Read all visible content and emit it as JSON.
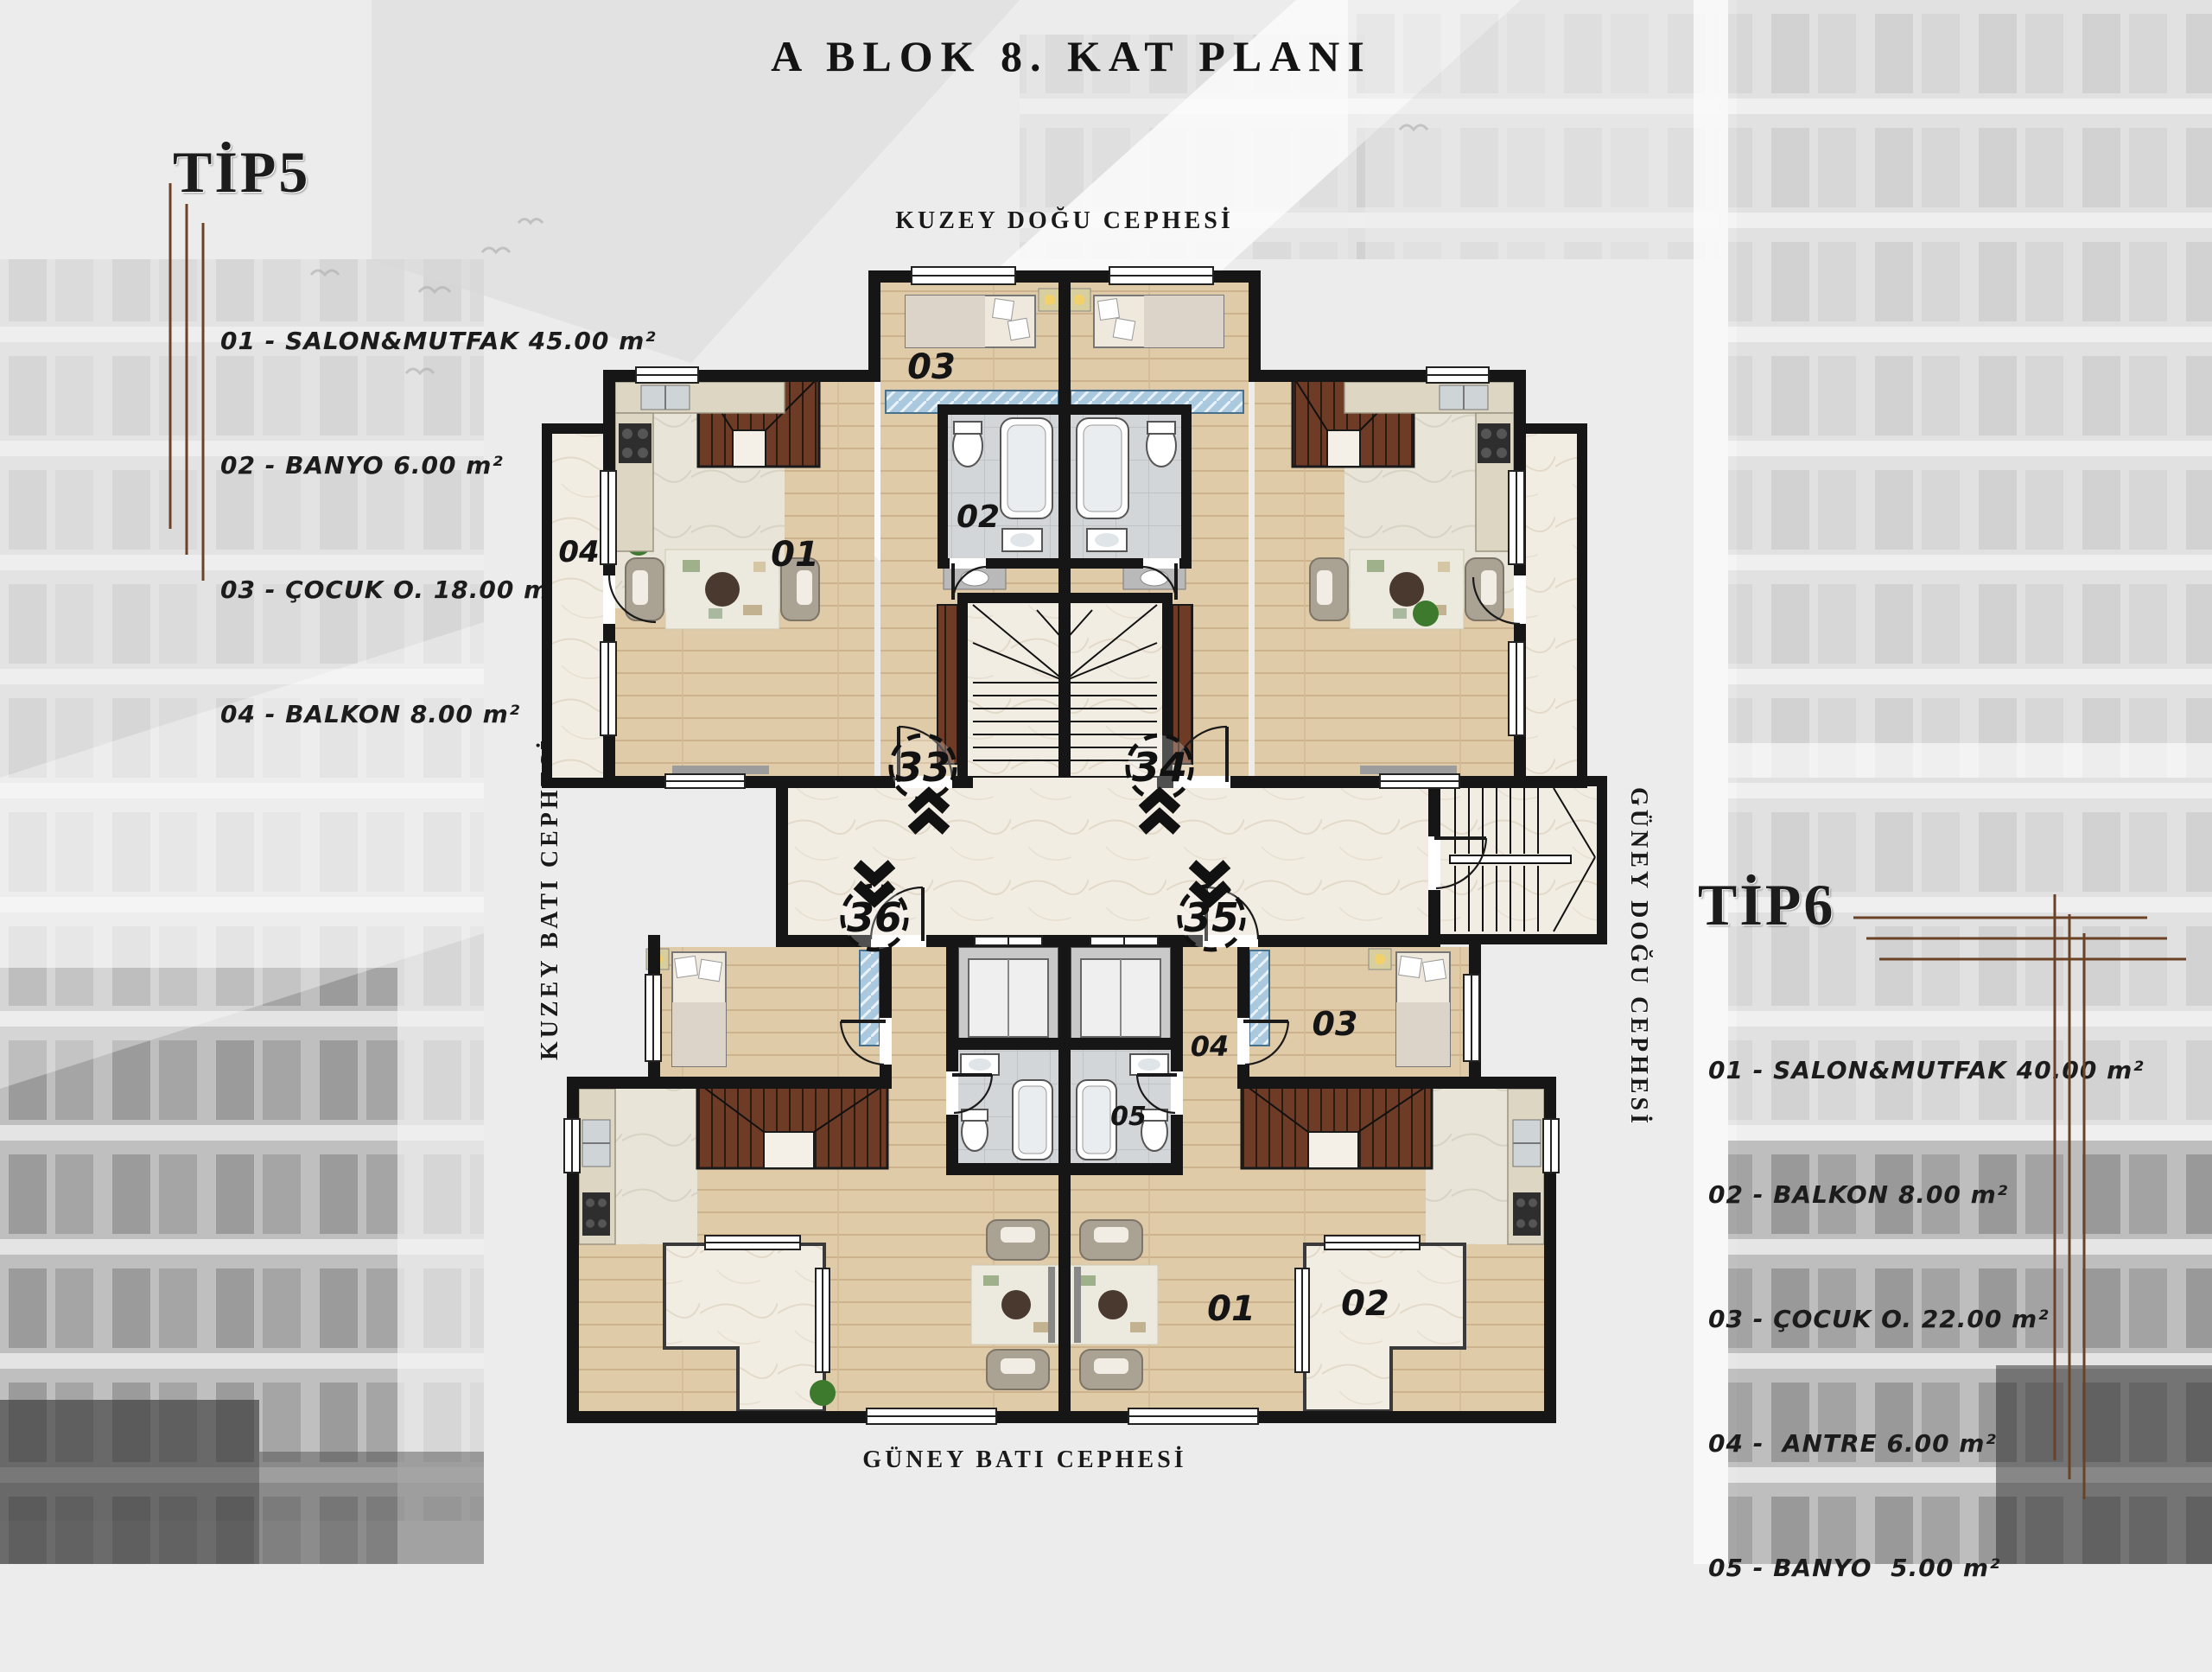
{
  "title": "A BLOK 8. KAT PLANI",
  "legends": {
    "tip5": {
      "heading": "TİP5",
      "items": [
        "01 - SALON&MUTFAK 45.00 m²",
        "02 - BANYO 6.00 m²",
        "03 - ÇOCUK O. 18.00 m²",
        "04 - BALKON 8.00 m²"
      ]
    },
    "tip6": {
      "heading": "TİP6",
      "items": [
        "01 - SALON&MUTFAK 40.00 m²",
        "02 - BALKON 8.00 m²",
        "03 - ÇOCUK O. 22.00 m²",
        "04 -  ANTRE 6.00 m²",
        "05 - BANYO  5.00 m²"
      ]
    }
  },
  "facades": {
    "top": "KUZEY DOĞU CEPHESİ",
    "bottom": "GÜNEY BATI CEPHESİ",
    "left": "KUZEY BATI CEPHESİ",
    "right": "GÜNEY DOĞU CEPHESİ"
  },
  "plan": {
    "units": {
      "u33": "33",
      "u34": "34",
      "u35": "35",
      "u36": "36"
    },
    "room_labels": {
      "tip5_cocuk": "03",
      "tip5_banyo": "02",
      "tip5_salon": "01",
      "tip5_balkon": "04",
      "tip6_cocuk": "03",
      "tip6_antre": "04",
      "tip6_banyo": "05",
      "tip6_salon": "01",
      "tip6_balkon": "02"
    }
  },
  "colors": {
    "wall": "#161616",
    "wood": "#e0cba9",
    "marble": "#f2ede3",
    "tile": "#d3d6d8",
    "stair_wood": "#6e3b26",
    "glass": "#aac9de",
    "accent_line": "#6b4226",
    "plant": "#3d7a2e"
  }
}
